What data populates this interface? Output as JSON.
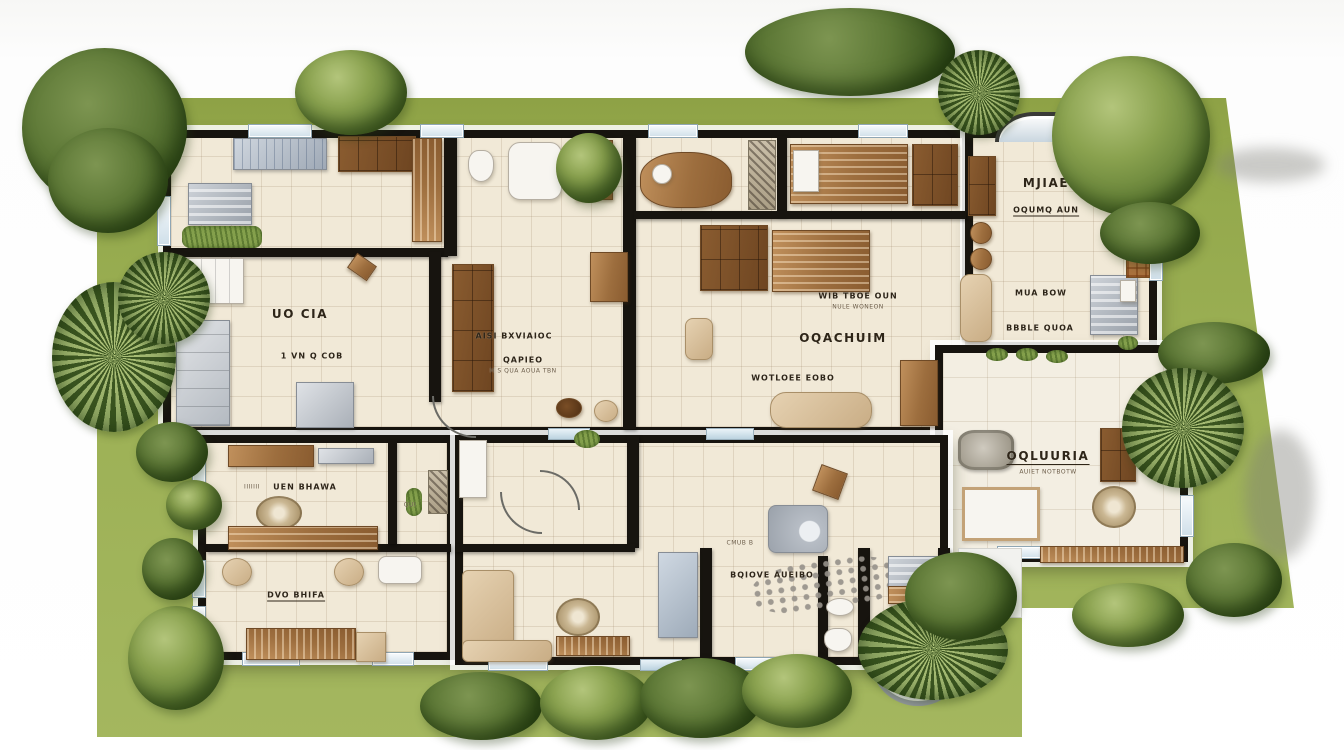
{
  "scene": "residential-floor-plan-site-rendering",
  "colors": {
    "lawn": "#97ab50",
    "wall": "#17140f",
    "floor": "#f1e9d7",
    "patio_floor": "#f3eee2",
    "wood": "#a87a4c",
    "window_glass": "#dfeaf1",
    "foliage": "#5d7a33",
    "label_ink": "#2e2518"
  },
  "labels": {
    "living": {
      "line1": "UO CIA",
      "line2": "1 VN Q COB"
    },
    "closet": {
      "line1": "AISI BXVIAIOC",
      "line2": "QAPIEO",
      "sub": "M S QUA AOUA TBN"
    },
    "great": {
      "small": "WIB TBOE OUN",
      "small_sub": "NULE WONEON",
      "main": "OQACHUIM",
      "bottom": "WOTLOEE EOBO"
    },
    "master": {
      "line1": "MJIAE",
      "line2": "OQUMQ AUN",
      "line3": "MUA BOW",
      "line4": "BBBLE QUOA"
    },
    "patio": {
      "main": "OQLUURIA",
      "sub": "AUIET NOTBOTW"
    },
    "family": {
      "prefix": "IIIIIII",
      "main": "UEN BHAWA"
    },
    "qui": {
      "main": "QUI"
    },
    "bottom_left": {
      "main": "DVO BHIFA"
    },
    "lounge": {
      "small": "CMUB B",
      "main": "BQIOVE AUEIBO"
    },
    "entry": {
      "main": "BBI AUNOR"
    }
  }
}
